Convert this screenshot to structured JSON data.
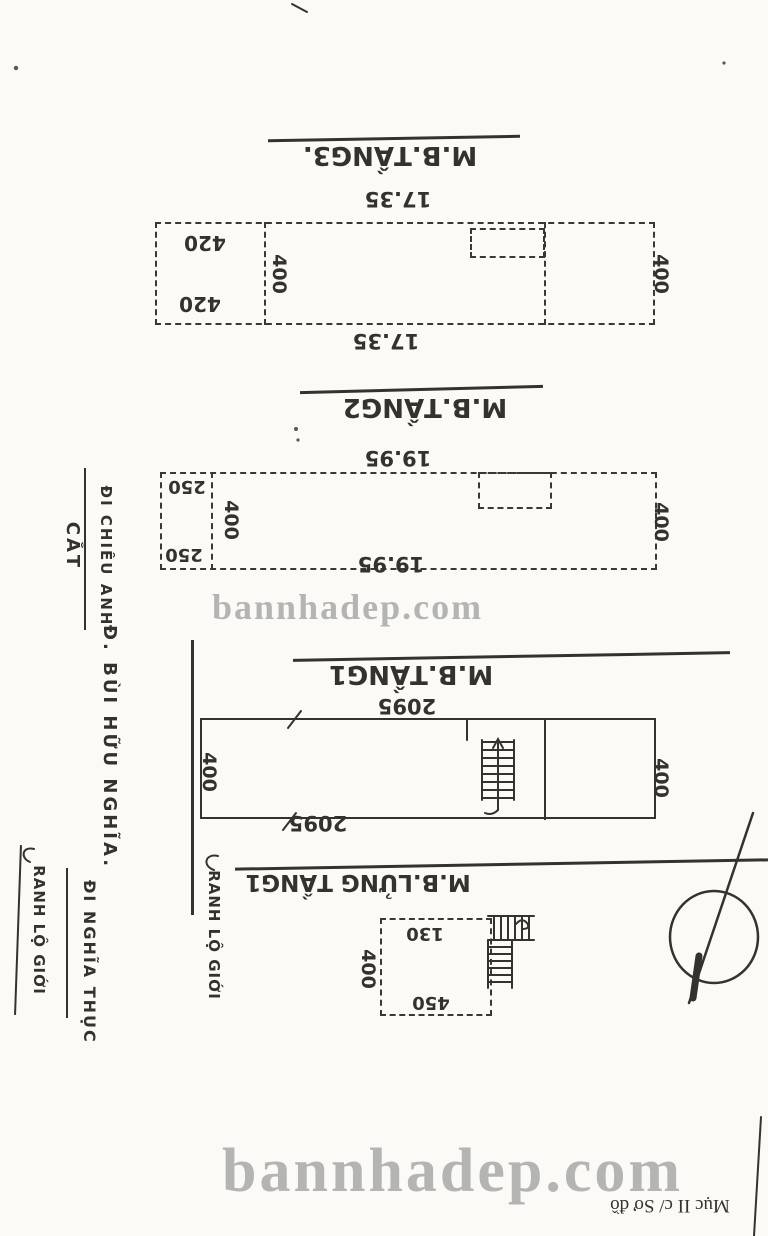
{
  "page": {
    "background": "#fbfaf6",
    "ink": "#34322e",
    "watermark_color": "#7a7a7a"
  },
  "watermarks": {
    "small": "bannhadep.com",
    "large": "bannhadep.com"
  },
  "corner_note": {
    "text": "Mục II c/ Sơ đồ"
  },
  "left_margin": {
    "di_chieu_anh": "ĐI CHIÊU ANH",
    "section_cut": "CẮT",
    "street_name": "Đ. BÙI HỮU NGHĨA.",
    "boundary_left": "RANH LỘ GIỚI",
    "di_nghia_thuc": "ĐI NGHĨA THỤC",
    "boundary_mid": "RANH LỘ GIỚI"
  },
  "plans": {
    "tang3": {
      "label": "M.B.TẦNG3.",
      "dim_top": "17.35",
      "dim_bottom": "17.35",
      "room_width_top": "420",
      "room_width_bottom": "420",
      "depth_left": "400",
      "depth_right": "400"
    },
    "tang2": {
      "label": "M.B.TẦNG2",
      "dim_top": "19.95",
      "dim_bottom": "19.95",
      "room_width_top": "250",
      "room_width_bottom": "250",
      "depth_left": "400",
      "depth_right": "400"
    },
    "tang1": {
      "label": "M.B.TẦNG1",
      "dim_top": "2095",
      "dim_bottom": "2095",
      "depth_left": "400",
      "depth_right": "400"
    },
    "lung_tang1": {
      "label": "M.B.LỬNG TẦNG1",
      "dim_top": "130",
      "dim_bottom": "450",
      "depth_left": "400"
    }
  }
}
